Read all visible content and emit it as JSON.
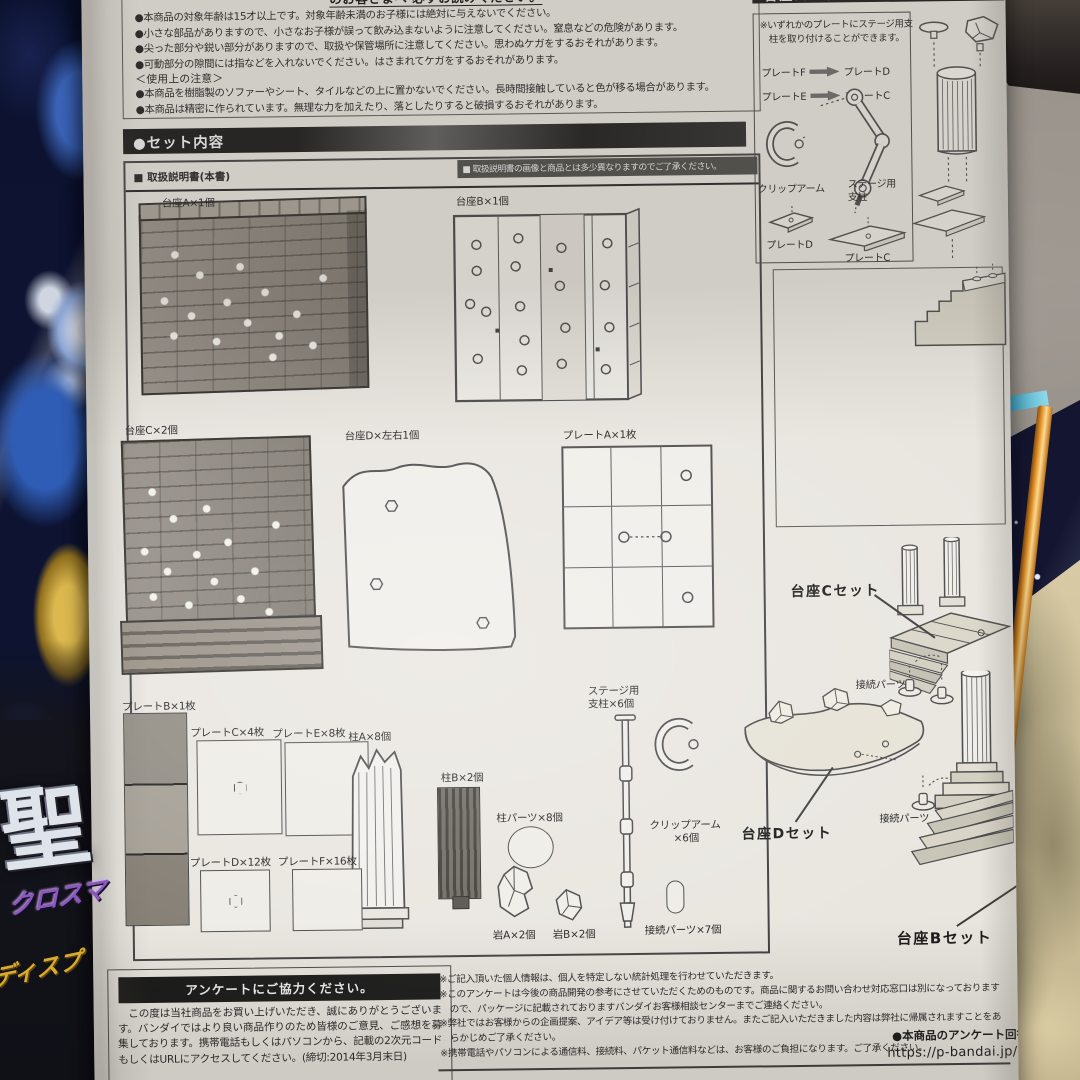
{
  "colors": {
    "paper": "#e9e6e0",
    "bar_black": "#161616",
    "note_bar": "#4a4a46",
    "line_art": "#4a4a4a",
    "carpet": "#948d85",
    "starfield": "#141631",
    "orange_edge": "#e89a2e",
    "tan_parts": "#cfc09b"
  },
  "box_art": {
    "logo": "聖",
    "sub": "クロスマ",
    "gold": "ディスプ"
  },
  "warnings": {
    "heading": "のお客さまへ 必ずお読みください。",
    "items": [
      "●本商品の対象年齢は15才以上です。対象年齢未満のお子様には絶対に与えないでください。",
      "●小さな部品がありますので、小さなお子様が誤って飲み込まないように注意してください。窒息などの危険があります。",
      "●尖った部分や鋭い部分がありますので、取扱や保管場所に注意してください。思わぬケガをするおそれがあります。",
      "●可動部分の隙間には指などを入れないでください。はさまれてケガをするおそれがあります。"
    ],
    "usage_heading": "＜使用上の注意＞",
    "usage_items": [
      "●本商品を樹脂製のソファーやシート、タイルなどの上に置かないでください。長時間接触していると色が移る場合があります。",
      "●本商品は精密に作られています。無理な力を加えたり、落としたりすると破損するおそれがあります。"
    ]
  },
  "set_contents": {
    "header": "●セット内容",
    "manual_label": "■ 取扱説明書(本書)",
    "note": "■ 取扱説明書の画像と商品とは多少異なりますのでご了承ください。",
    "parts": {
      "daiza_a": "台座A×1個",
      "daiza_b": "台座B×1個",
      "daiza_c": "台座C×2個",
      "daiza_d": "台座D×左右1個",
      "plate_a": "プレートA×1枚",
      "plate_b": "プレートB×1枚",
      "plate_c": "プレートC×4枚",
      "plate_e": "プレートE×8枚",
      "pillar_a": "柱A×8個",
      "pillar_b": "柱B×2個",
      "pillar_parts": "柱パーツ×8個",
      "stage_line1": "ステージ用",
      "stage_line2": "支柱×6個",
      "clip_line1": "クリップアーム",
      "clip_line2": "×6個",
      "plate_d": "プレートD×12枚",
      "plate_f": "プレートF×16枚",
      "rock_a": "岩A×2個",
      "rock_b": "岩B×2個",
      "connector": "接続パーツ×7個"
    }
  },
  "stage_guide": {
    "header": "台座パーツとステージ支柱",
    "note": "※いずれかのプレートにステージ用支柱を取り付けることができます。",
    "map1_from": "プレートF",
    "map1_to": "プレートD",
    "map2_from": "プレートE",
    "map2_to": "プレートC",
    "clip_label": "クリップアーム",
    "pillar_line1": "ステージ用",
    "pillar_line2": "支柱",
    "plate_d_label": "プレートD",
    "plate_c_label": "プレートC"
  },
  "assembly": {
    "set_c": "台座Cセット",
    "set_d": "台座Dセット",
    "set_b": "台座Bセット",
    "connector_1": "接続パーツ",
    "connector_2": "接続パーツ"
  },
  "survey": {
    "header": "アンケートにご協力ください。",
    "body": "この度は当社商品をお買い上げいただき、誠にありがとうございます。バンダイではより良い商品作りのため皆様のご意見、ご感想を募集しております。携帯電話もしくはパソコンから、記載の2次元コードもしくはURLにアクセスしてください。(締切:2014年3月末日)",
    "notes": [
      "※ご記入頂いた個人情報は、個人を特定しない統計処理を行わせていただきます。",
      "※このアンケートは今後の商品開発の参考にさせていただくためのものです。商品に関するお問い合わせ対応窓口は別になっておりますので、パッケージに記載されておりますバンダイお客様相談センターまでご連絡ください。",
      "※弊社ではお客様からの企画提案、アイデア等は受け付けておりません。またご記入いただきました内容は弊社に帰属されますことをあらかじめご了承ください。",
      "※携帯電話やパソコンによる通信料、接続料、パケット通信料などは、お客様のご負担になります。ご了承ください。"
    ],
    "answer_label": "●本商品のアンケート回答",
    "url": "https://p-bandai.jp/"
  }
}
